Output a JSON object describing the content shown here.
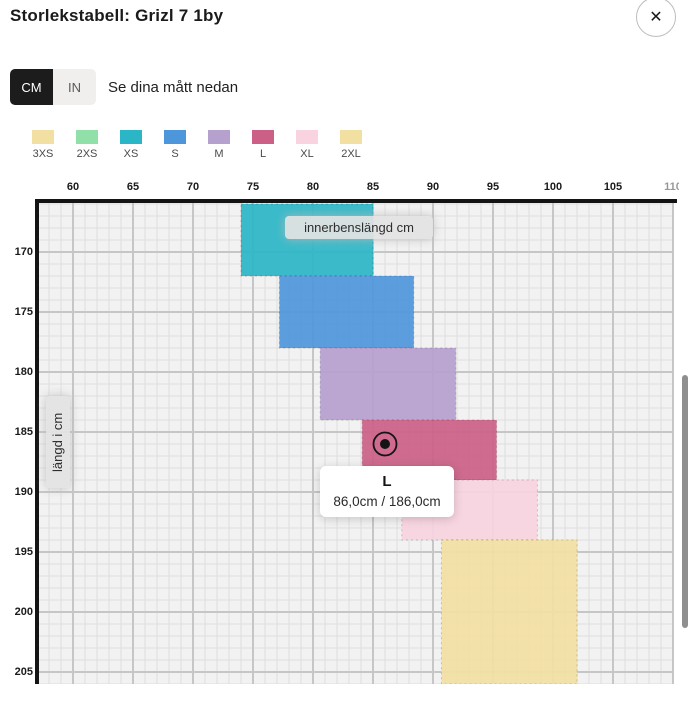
{
  "modal": {
    "title": "Storlekstabell: Grizl 7 1by",
    "close_label": "✕"
  },
  "unit_toggle": {
    "options": [
      {
        "label": "CM",
        "selected": true
      },
      {
        "label": "IN",
        "selected": false
      }
    ],
    "hint": "Se dina mått nedan"
  },
  "legend": {
    "items": [
      {
        "label": "3XS",
        "color": "#F2E0A3"
      },
      {
        "label": "2XS",
        "color": "#92E0A9"
      },
      {
        "label": "XS",
        "color": "#2BB6C7"
      },
      {
        "label": "S",
        "color": "#4E96DB"
      },
      {
        "label": "M",
        "color": "#B5A0CE"
      },
      {
        "label": "L",
        "color": "#CB5F85"
      },
      {
        "label": "XL",
        "color": "#F9D4E0"
      },
      {
        "label": "2XL",
        "color": "#F2E0A3"
      }
    ]
  },
  "chart_data": {
    "type": "area",
    "title": "",
    "xlabel": "innerbenslängd cm",
    "ylabel": "längd i cm",
    "x_ticks": [
      60,
      65,
      70,
      75,
      80,
      85,
      90,
      95,
      100,
      105,
      110
    ],
    "y_ticks": [
      170,
      175,
      180,
      185,
      190,
      195,
      200,
      205
    ],
    "xlim": [
      57.6,
      110
    ],
    "ylim": [
      166,
      206
    ],
    "grid": true,
    "legend_position": "top",
    "series": [
      {
        "name": "XS",
        "color": "#2BB6C7",
        "inseam_cm": [
          74.0,
          85.0
        ],
        "height_cm": [
          166,
          172
        ]
      },
      {
        "name": "S",
        "color": "#4E96DB",
        "inseam_cm": [
          77.2,
          88.4
        ],
        "height_cm": [
          172,
          178
        ]
      },
      {
        "name": "M",
        "color": "#B5A0CE",
        "inseam_cm": [
          80.6,
          91.9
        ],
        "height_cm": [
          178,
          184
        ]
      },
      {
        "name": "L",
        "color": "#CB5F85",
        "inseam_cm": [
          84.1,
          95.3
        ],
        "height_cm": [
          184,
          189
        ]
      },
      {
        "name": "XL",
        "color": "#F9D4E0",
        "inseam_cm": [
          87.4,
          98.7
        ],
        "height_cm": [
          189,
          194
        ]
      },
      {
        "name": "2XL",
        "color": "#F2E0A3",
        "inseam_cm": [
          90.7,
          102.0
        ],
        "height_cm": [
          194,
          206
        ]
      }
    ],
    "marker": {
      "inseam_cm": 86.0,
      "height_cm": 186.0
    },
    "tooltip": {
      "size": "L",
      "value": "86,0cm / 186,0cm"
    }
  }
}
